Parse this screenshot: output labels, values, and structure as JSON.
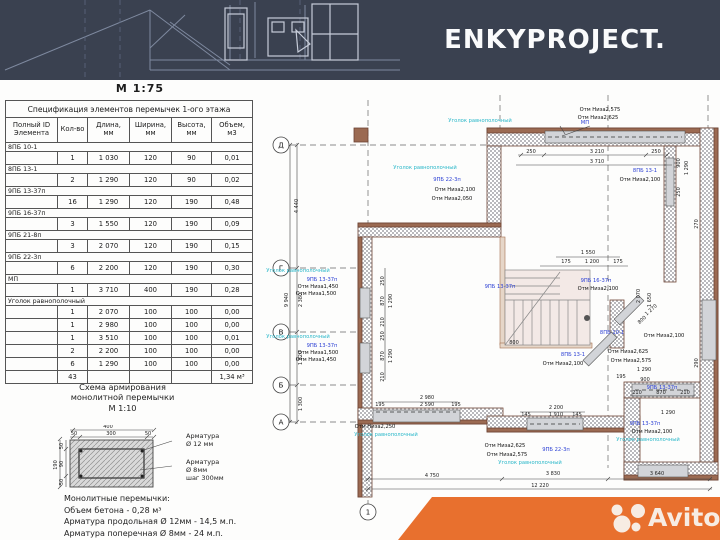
{
  "colors": {
    "navy": "#3A4150",
    "orange": "#E8702E",
    "wall_brown": "#9B6A52",
    "wall_edge": "#6D4434",
    "blue_label": "#2B3FD4",
    "teal_label": "#29B7C9",
    "lintel_gray": "#D2D4D8"
  },
  "header": {
    "logo": "ENKYPROJECT.",
    "scale_label": "М 1:75"
  },
  "spec_table": {
    "title": "Спецификация элементов перемычек 1-ого этажа",
    "headers": [
      "Полный ID\nЭлемента",
      "Кол-во",
      "Длина,\nмм",
      "Ширина,\nмм",
      "Высота,\nмм",
      "Объем,\nм3"
    ],
    "groups": [
      {
        "id": "8ПБ 10-1",
        "rows": [
          [
            "1",
            "1 030",
            "120",
            "90",
            "0,01"
          ]
        ]
      },
      {
        "id": "8ПБ 13-1",
        "rows": [
          [
            "2",
            "1 290",
            "120",
            "90",
            "0,02"
          ]
        ]
      },
      {
        "id": "9ПБ 13-37п",
        "rows": [
          [
            "16",
            "1 290",
            "120",
            "190",
            "0,48"
          ]
        ]
      },
      {
        "id": "9ПБ 16-37п",
        "rows": [
          [
            "3",
            "1 550",
            "120",
            "190",
            "0,09"
          ]
        ]
      },
      {
        "id": "9ПБ 21-8п",
        "rows": [
          [
            "3",
            "2 070",
            "120",
            "190",
            "0,15"
          ]
        ]
      },
      {
        "id": "9ПБ 22-3п",
        "rows": [
          [
            "6",
            "2 200",
            "120",
            "190",
            "0,30"
          ]
        ]
      },
      {
        "id": "МП",
        "rows": [
          [
            "1",
            "3 710",
            "400",
            "190",
            "0,28"
          ]
        ]
      },
      {
        "id": "Уголок равнополочный",
        "rows": [
          [
            "1",
            "2 070",
            "100",
            "100",
            "0,00"
          ],
          [
            "1",
            "2 980",
            "100",
            "100",
            "0,00"
          ],
          [
            "1",
            "3 510",
            "100",
            "100",
            "0,01"
          ],
          [
            "2",
            "2 200",
            "100",
            "100",
            "0,00"
          ],
          [
            "6",
            "1 290",
            "100",
            "100",
            "0,00"
          ]
        ]
      }
    ],
    "total": [
      "43",
      "",
      "",
      "",
      "1,34 м³"
    ]
  },
  "rebar": {
    "title": "Схема армирования\nмонолитной перемычки\nМ 1:10",
    "dims": {
      "top_total": "400",
      "top_left": "50",
      "top_mid": "300",
      "top_right": "50",
      "left_total": "190",
      "left_a": "50",
      "left_b": "90",
      "left_c": "50"
    },
    "label_long": "Арматура\nØ 12 мм",
    "label_trans": "Арматура\nØ 8мм\nшаг 300мм"
  },
  "notes": {
    "line1": "Монолитные перемычки:",
    "line2": "Объем бетона - 0,28 м³",
    "line3": "Арматура продольная Ø 12мм - 14,5 м.п.",
    "line4": "Арматура поперечная Ø 8мм - 24 м.п."
  },
  "watermark": {
    "brand": "Avito"
  },
  "plan": {
    "axes": [
      {
        "t": "Д",
        "x": 281,
        "y": 145
      },
      {
        "t": "Г",
        "x": 281,
        "y": 268
      },
      {
        "t": "В",
        "x": 281,
        "y": 332
      },
      {
        "t": "Б",
        "x": 281,
        "y": 385
      },
      {
        "t": "А",
        "x": 281,
        "y": 422
      },
      {
        "t": "1",
        "x": 368,
        "y": 512
      }
    ],
    "dims": [
      {
        "t": "9 940",
        "x": 288,
        "y": 300,
        "r": -90
      },
      {
        "t": "4 440",
        "x": 298,
        "y": 206,
        "r": -90
      },
      {
        "t": "2 380",
        "x": 302,
        "y": 300,
        "r": -90
      },
      {
        "t": "1 820",
        "x": 302,
        "y": 358,
        "r": -90
      },
      {
        "t": "1 300",
        "x": 302,
        "y": 404,
        "r": -90
      },
      {
        "t": "250",
        "x": 531,
        "y": 153
      },
      {
        "t": "3 210",
        "x": 597,
        "y": 153
      },
      {
        "t": "250",
        "x": 656,
        "y": 153
      },
      {
        "t": "3 710",
        "x": 597,
        "y": 163
      },
      {
        "t": "900",
        "x": 680,
        "y": 163,
        "r": -90
      },
      {
        "t": "1 290",
        "x": 688,
        "y": 168,
        "r": -90
      },
      {
        "t": "250",
        "x": 680,
        "y": 192,
        "r": -90
      },
      {
        "t": "1 550",
        "x": 588,
        "y": 254
      },
      {
        "t": "175",
        "x": 566,
        "y": 263
      },
      {
        "t": "1 200",
        "x": 592,
        "y": 263
      },
      {
        "t": "175",
        "x": 618,
        "y": 263
      },
      {
        "t": "800",
        "x": 514,
        "y": 344
      },
      {
        "t": "2 070",
        "x": 640,
        "y": 296,
        "r": -90
      },
      {
        "t": "1 650",
        "x": 651,
        "y": 300,
        "r": -90
      },
      {
        "t": "270",
        "x": 698,
        "y": 224,
        "r": -90
      },
      {
        "t": "290",
        "x": 698,
        "y": 363,
        "r": -90
      },
      {
        "t": "1 270",
        "x": 652,
        "y": 311,
        "r": -42
      },
      {
        "t": "800",
        "x": 643,
        "y": 321,
        "r": -42
      },
      {
        "t": "250",
        "x": 384,
        "y": 281,
        "r": -90
      },
      {
        "t": "870",
        "x": 384,
        "y": 301,
        "r": -90
      },
      {
        "t": "1 290",
        "x": 392,
        "y": 301,
        "r": -90
      },
      {
        "t": "210",
        "x": 384,
        "y": 322,
        "r": -90
      },
      {
        "t": "250",
        "x": 384,
        "y": 336,
        "r": -90
      },
      {
        "t": "870",
        "x": 384,
        "y": 356,
        "r": -90
      },
      {
        "t": "1 290",
        "x": 392,
        "y": 356,
        "r": -90
      },
      {
        "t": "210",
        "x": 384,
        "y": 377,
        "r": -90
      },
      {
        "t": "195",
        "x": 621,
        "y": 378
      },
      {
        "t": "1 290",
        "x": 644,
        "y": 371
      },
      {
        "t": "900",
        "x": 645,
        "y": 381
      },
      {
        "t": "2 980",
        "x": 427,
        "y": 399
      },
      {
        "t": "2 590",
        "x": 427,
        "y": 406
      },
      {
        "t": "195",
        "x": 380,
        "y": 406
      },
      {
        "t": "195",
        "x": 456,
        "y": 406
      },
      {
        "t": "2 200",
        "x": 556,
        "y": 409
      },
      {
        "t": "1 910",
        "x": 556,
        "y": 416
      },
      {
        "t": "145",
        "x": 526,
        "y": 416
      },
      {
        "t": "145",
        "x": 577,
        "y": 416
      },
      {
        "t": "210",
        "x": 637,
        "y": 394
      },
      {
        "t": "870",
        "x": 661,
        "y": 394
      },
      {
        "t": "210",
        "x": 685,
        "y": 394
      },
      {
        "t": "1 290",
        "x": 668,
        "y": 414
      },
      {
        "t": "4 750",
        "x": 432,
        "y": 477
      },
      {
        "t": "3 830",
        "x": 553,
        "y": 475
      },
      {
        "t": "3 640",
        "x": 657,
        "y": 475
      },
      {
        "t": "12 220",
        "x": 540,
        "y": 487
      }
    ],
    "labels": [
      {
        "t": "Уголок равнополочный",
        "c": "teal",
        "x": 480,
        "y": 122
      },
      {
        "t": "МП",
        "c": "blue",
        "x": 585,
        "y": 124
      },
      {
        "t": "Отм Низа2,575",
        "x": 600,
        "y": 111
      },
      {
        "t": "Отм Низа2,625",
        "x": 598,
        "y": 119
      },
      {
        "t": "8ПБ 13-1",
        "c": "blue",
        "x": 645,
        "y": 172
      },
      {
        "t": "Отм Низа2,100",
        "x": 640,
        "y": 181
      },
      {
        "t": "Уголок равнополочный",
        "c": "teal",
        "x": 425,
        "y": 169
      },
      {
        "t": "9ПБ 22-3п",
        "c": "blue",
        "x": 447,
        "y": 181
      },
      {
        "t": "Отм Низа2,100",
        "x": 455,
        "y": 191
      },
      {
        "t": "Отм Низа2,050",
        "x": 452,
        "y": 200
      },
      {
        "t": "Уголок равнополочный",
        "c": "teal",
        "x": 298,
        "y": 272
      },
      {
        "t": "9ПБ 13-37п",
        "c": "blue",
        "x": 322,
        "y": 281
      },
      {
        "t": "Отм Низа1,450",
        "x": 318,
        "y": 288
      },
      {
        "t": "Отм Низа1,500",
        "x": 316,
        "y": 295
      },
      {
        "t": "Уголок равнополочный",
        "c": "teal",
        "x": 298,
        "y": 338
      },
      {
        "t": "9ПБ 13-37п",
        "c": "blue",
        "x": 322,
        "y": 347
      },
      {
        "t": "Отм Низа1,500",
        "x": 318,
        "y": 354
      },
      {
        "t": "Отм Низа1,450",
        "x": 316,
        "y": 361
      },
      {
        "t": "9ПБ 13-37п",
        "c": "blue",
        "x": 500,
        "y": 288
      },
      {
        "t": "9ПБ 16-37п",
        "c": "blue",
        "x": 596,
        "y": 282
      },
      {
        "t": "Отм Низа2,100",
        "x": 598,
        "y": 290
      },
      {
        "t": "8ПБ 10-1",
        "c": "blue",
        "x": 612,
        "y": 334
      },
      {
        "t": "Отм Низа2,100",
        "x": 664,
        "y": 337
      },
      {
        "t": "8ПБ 13-1",
        "c": "blue",
        "x": 573,
        "y": 356
      },
      {
        "t": "Отм Низа2,100",
        "x": 563,
        "y": 365
      },
      {
        "t": "Отм Низа2,625",
        "x": 628,
        "y": 353
      },
      {
        "t": "Отм Низа2,575",
        "x": 631,
        "y": 362
      },
      {
        "t": "9ПБ 13-37п",
        "c": "blue",
        "x": 662,
        "y": 389
      },
      {
        "t": "Отм Низа2,250",
        "x": 375,
        "y": 428
      },
      {
        "t": "Уголок равнополочный",
        "c": "teal",
        "x": 386,
        "y": 436
      },
      {
        "t": "Отм Низа2,625",
        "x": 505,
        "y": 447
      },
      {
        "t": "Отм Низа2,575",
        "x": 507,
        "y": 456
      },
      {
        "t": "9ПБ 22-3п",
        "c": "blue",
        "x": 556,
        "y": 451
      },
      {
        "t": "Уголок равнополочный",
        "c": "teal",
        "x": 530,
        "y": 464
      },
      {
        "t": "9ПБ 13-37п",
        "c": "blue",
        "x": 645,
        "y": 425
      },
      {
        "t": "Отм Низа2,100",
        "x": 652,
        "y": 433
      },
      {
        "t": "Уголок равнополочный",
        "c": "teal",
        "x": 648,
        "y": 441
      }
    ]
  }
}
